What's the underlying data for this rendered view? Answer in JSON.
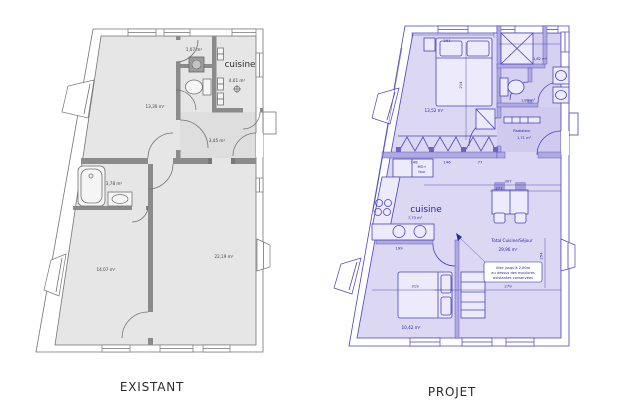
{
  "page": {
    "background": "#ffffff"
  },
  "plans": {
    "existant": {
      "caption": "EXISTANT",
      "rooms": {
        "sejour": "13,30 m²",
        "debarras": "1,07 m²",
        "cuisine_label": "cuisine",
        "cuisine_area": "4,01 m²",
        "hall": "3,45 m²",
        "sdb": "3,78 m²",
        "chambre": "14,07 m²",
        "sejour2": "22,19 m²"
      },
      "colors": {
        "wall": "#cccccc",
        "hatch": "#969696",
        "line": "#777777",
        "text": "#3f3f3f"
      }
    },
    "projet": {
      "caption": "PROJET",
      "rooms": {
        "chambre1": "13,52 m²",
        "sde": "1,82 m²",
        "wc": "1,80 m²",
        "radiateur": "Radiateur",
        "entree": "1,71 m²",
        "cuisine_label": "cuisine",
        "cuisine_area": "7,73 m²",
        "mo_line1": "MO+",
        "mo_line2": "four",
        "total_label": "Total Cuisine/Séjour",
        "total_area": "29,96 m²",
        "note1": "Vide jusqu'à 2,80m",
        "note2": "au dessus des moulures",
        "note3": "existantes conservées",
        "chambre2": "10,42 m²"
      },
      "dims": {
        "d291": "291",
        "d214": "214",
        "d148": "148",
        "d146": "146",
        "d77": "77",
        "d307": "307",
        "d277": "277",
        "d254": "254",
        "d279": "279",
        "d319": "319",
        "d199": "199"
      },
      "colors": {
        "wall": "#beb9ea",
        "hatch": "#8a82d6",
        "line": "#4a43b8",
        "text": "#2a24a8"
      }
    }
  }
}
